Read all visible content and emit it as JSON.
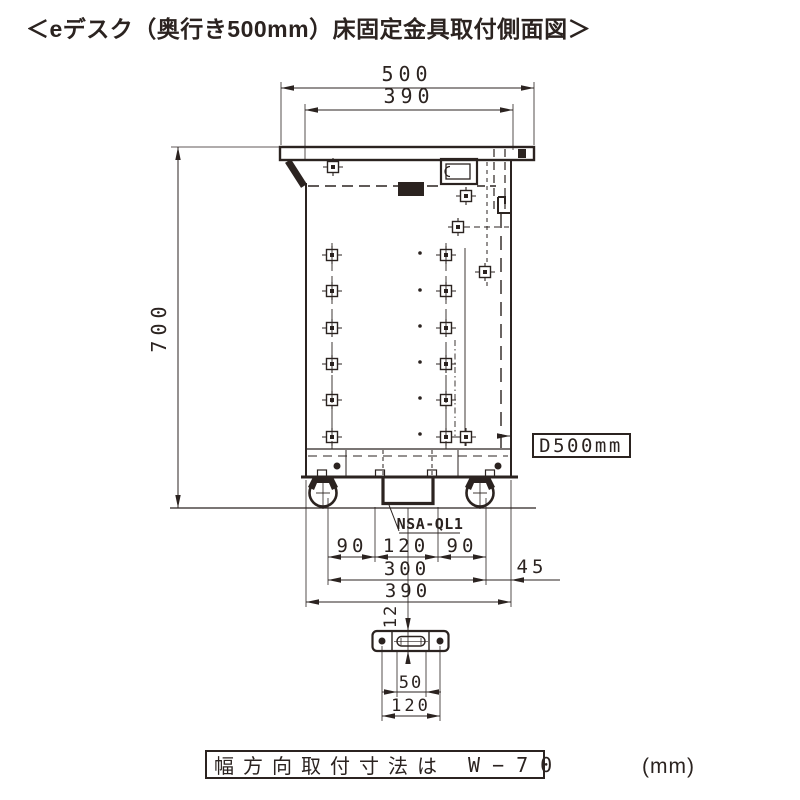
{
  "title": "＜eデスク（奥行き500mm）床固定金具取付側面図＞",
  "colors": {
    "line": "#2b2320",
    "background": "#ffffff"
  },
  "labels": {
    "bracket_model": "NSA-QL1",
    "depth_tag": "D500mm",
    "note_text": "幅方向取付寸法は",
    "note_value": "W−70",
    "unit": "(mm)"
  },
  "dims": {
    "desk_depth": "500",
    "top_inner_depth": "390",
    "desk_height": "700",
    "bracket_left": "90",
    "bracket_center": "120",
    "bracket_right": "90",
    "bracket_span": "300",
    "rear_offset": "45",
    "base_depth": "390",
    "plate_width": "12",
    "plate_slot_length": "50",
    "plate_hole_pitch": "120"
  }
}
